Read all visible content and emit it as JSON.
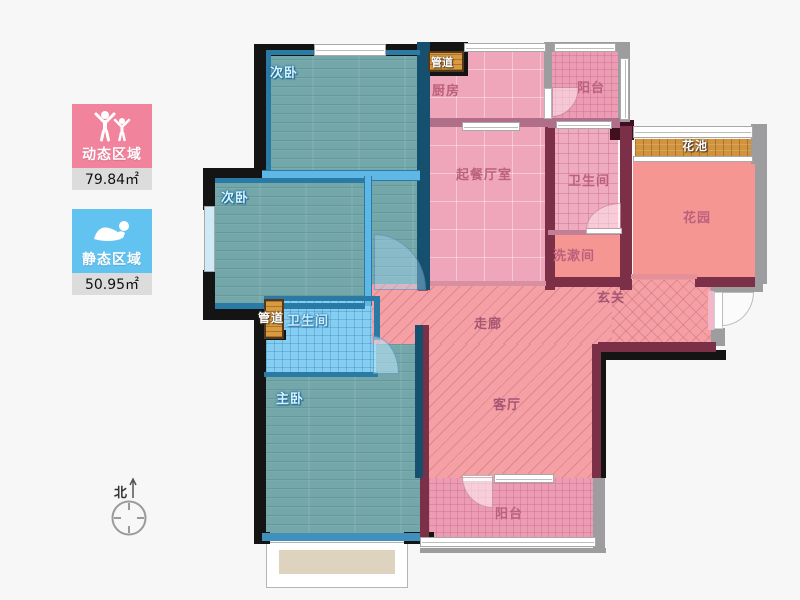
{
  "legend": {
    "dynamic": {
      "label": "动态区域",
      "value": "79.84㎡",
      "color": "#f2839d",
      "icon": "cheering-people-icon"
    },
    "static": {
      "label": "静态区域",
      "value": "50.95㎡",
      "color": "#63c3f0",
      "icon": "crawling-person-icon"
    }
  },
  "compass": {
    "label": "北"
  },
  "palette": {
    "wall_dark": "#141414",
    "wall_maroon": "#7b3048",
    "wall_gray": "#9d9da0",
    "wall_blue": "#2a7aa6",
    "floor_teal": "#73a7aa",
    "floor_pink": "#efa6ba",
    "floor_salmon": "#f5a0a5",
    "floor_lightblue": "#85cef2",
    "wood": "#d1933c"
  },
  "rooms": [
    {
      "id": "bedroom-top",
      "label": "次卧"
    },
    {
      "id": "bedroom-left",
      "label": "次卧"
    },
    {
      "id": "master-bedroom",
      "label": "主卧"
    },
    {
      "id": "master-bathroom",
      "label": "卫生间"
    },
    {
      "id": "duct-lower",
      "label": "管道"
    },
    {
      "id": "kitchen",
      "label": "厨房"
    },
    {
      "id": "duct-upper",
      "label": "管道"
    },
    {
      "id": "balcony-top",
      "label": "阳台"
    },
    {
      "id": "living-dining",
      "label": "起餐厅室"
    },
    {
      "id": "bathroom-upper",
      "label": "卫生间"
    },
    {
      "id": "washroom",
      "label": "洗漱间"
    },
    {
      "id": "flower-bed",
      "label": "花池"
    },
    {
      "id": "garden",
      "label": "花园"
    },
    {
      "id": "hallway",
      "label": "走廊"
    },
    {
      "id": "foyer",
      "label": "玄关"
    },
    {
      "id": "living-room",
      "label": "客厅"
    },
    {
      "id": "balcony-bottom",
      "label": "阳台"
    }
  ]
}
